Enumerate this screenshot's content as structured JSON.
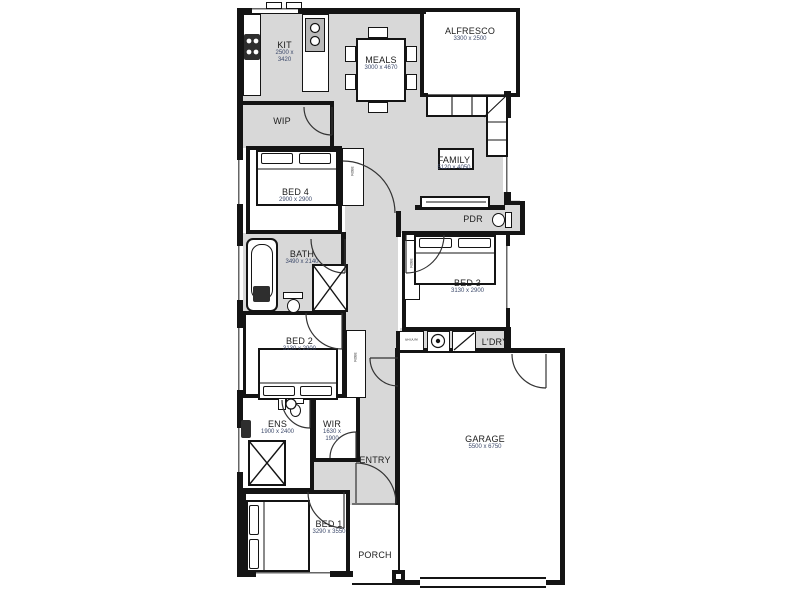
{
  "figure": {
    "type": "floor-plan"
  },
  "colors": {
    "floor": "#d8d8d8",
    "wall": "#141414",
    "room_bg": "#ffffff",
    "dim_text": "#3d4a6b"
  },
  "rooms": {
    "kit": {
      "name": "KIT",
      "dim1": "2500 x",
      "dim2": "3420"
    },
    "meals": {
      "name": "MEALS",
      "dims": "3000 x 4670"
    },
    "alfresco": {
      "name": "ALFRESCO",
      "dims": "3300 x 2500"
    },
    "wip": {
      "name": "WIP"
    },
    "family": {
      "name": "FAMILY",
      "dims": "5120 x 4050"
    },
    "bed4": {
      "name": "BED 4",
      "dims": "2900 x 2900"
    },
    "bath": {
      "name": "BATH",
      "dims": "3490 x 2140"
    },
    "pdr": {
      "name": "PDR"
    },
    "bed3": {
      "name": "BED 3",
      "dims": "3130 x 2900"
    },
    "bed2": {
      "name": "BED 2",
      "dims": "3130 x 2900"
    },
    "broom": {
      "name": "BROOM"
    },
    "ldry": {
      "name": "L'DRY"
    },
    "ens": {
      "name": "ENS",
      "dims": "1900 x 2400"
    },
    "wir": {
      "name": "WIR",
      "dim1": "1630 x",
      "dim2": "1900"
    },
    "entry": {
      "name": "ENTRY"
    },
    "garage": {
      "name": "GARAGE",
      "dims": "5500 x 6750"
    },
    "bed1": {
      "name": "BED 1",
      "dims": "3290 x 3550"
    },
    "porch": {
      "name": "PORCH"
    },
    "robe": {
      "name": "ROBE"
    }
  }
}
